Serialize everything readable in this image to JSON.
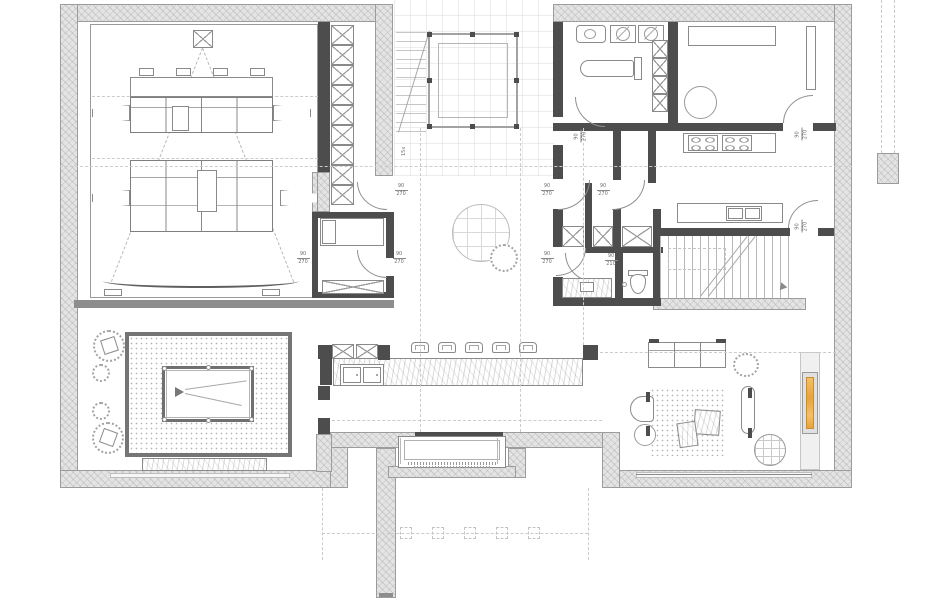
{
  "labels": {
    "door_width": "90",
    "door_height": "270",
    "wc_door_height": "210",
    "stair_note": "15x"
  },
  "colors": {
    "background": "#ffffff",
    "exterior_wall": "#e4e4e4",
    "interior_wall": "#4d4d4d",
    "drawing_line": "#8a8a8a",
    "fireplace_accent": "#e8a23c"
  }
}
